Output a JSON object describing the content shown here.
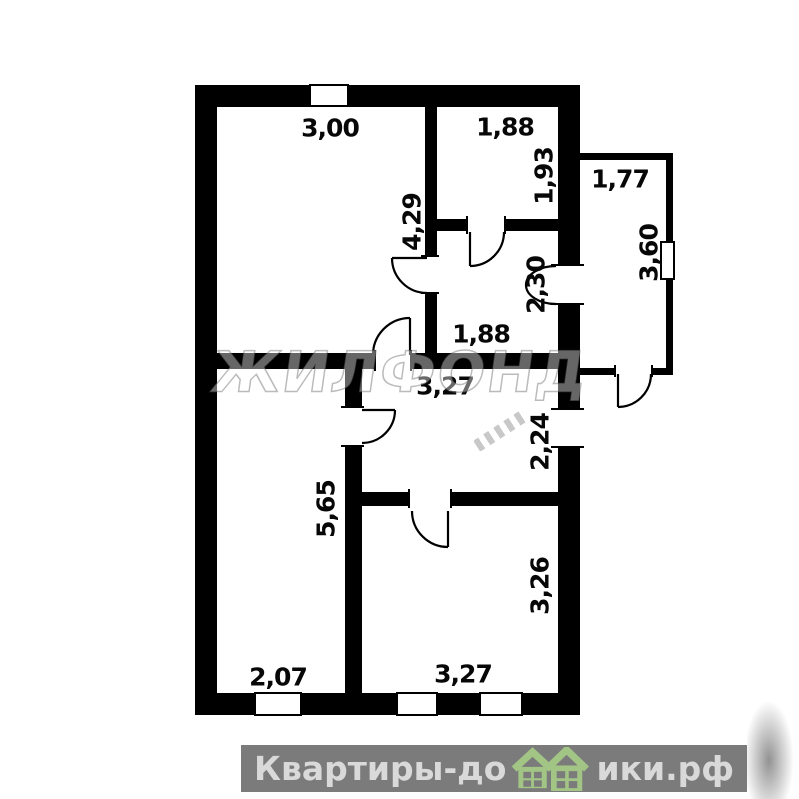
{
  "plan": {
    "type": "floor-plan",
    "dimensions": [
      {
        "id": "top-left-room-width",
        "text": "3,00",
        "orientation": "horizontal"
      },
      {
        "id": "top-right-room-width",
        "text": "1,88",
        "orientation": "horizontal"
      },
      {
        "id": "top-right-room-height",
        "text": "1,93",
        "orientation": "vertical"
      },
      {
        "id": "annex-width",
        "text": "1,77",
        "orientation": "horizontal"
      },
      {
        "id": "top-left-room-height",
        "text": "4,29",
        "orientation": "vertical"
      },
      {
        "id": "annex-height",
        "text": "3,60",
        "orientation": "vertical"
      },
      {
        "id": "mid-right-room-height",
        "text": "2,30",
        "orientation": "vertical"
      },
      {
        "id": "mid-right-room-width",
        "text": "1,88",
        "orientation": "horizontal"
      },
      {
        "id": "hallway-width",
        "text": "3,27",
        "orientation": "horizontal"
      },
      {
        "id": "hallway-height",
        "text": "2,24",
        "orientation": "vertical"
      },
      {
        "id": "bottom-left-room-height",
        "text": "5,65",
        "orientation": "vertical"
      },
      {
        "id": "bottom-right-room-height",
        "text": "3,26",
        "orientation": "vertical"
      },
      {
        "id": "bottom-left-room-width",
        "text": "2,07",
        "orientation": "horizontal"
      },
      {
        "id": "bottom-right-room-width",
        "text": "3,27",
        "orientation": "horizontal"
      }
    ]
  },
  "watermark": {
    "logo_text": "ЖИЛФОНД"
  },
  "footer": {
    "brand_full": "Квартиры-домики.рф",
    "brand_left": "Квартиры-до",
    "brand_right": "ики.рф",
    "houses_icon": "two-green-houses"
  },
  "colors": {
    "wall": "#000000",
    "footer_bar": "#7b7b7b",
    "footer_text": "#d9d9d9",
    "house_green": "#a2c585"
  }
}
